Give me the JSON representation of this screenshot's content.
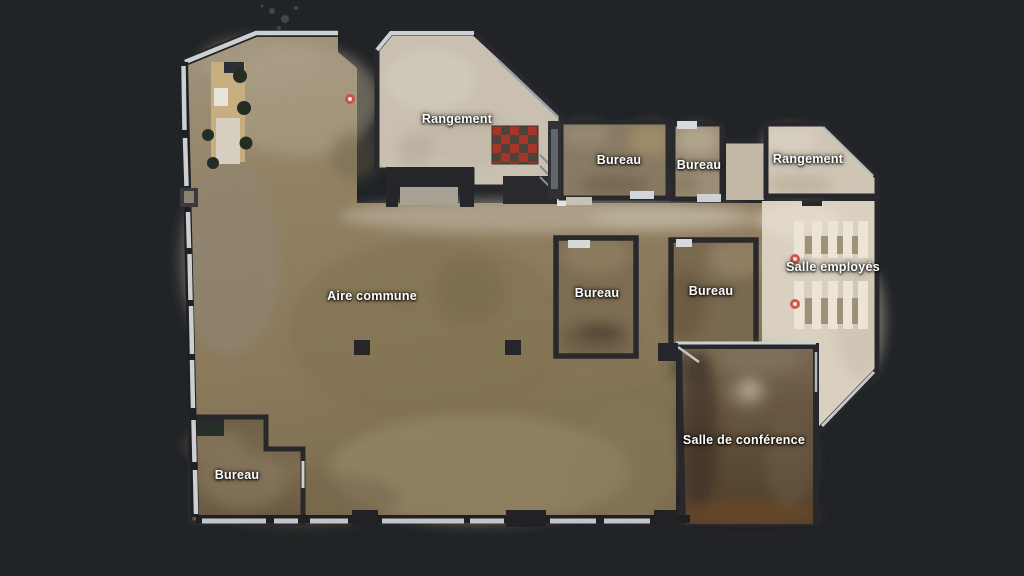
{
  "app": {
    "view": "floorplan",
    "background": "#212427"
  },
  "floorplan": {
    "rooms": [
      {
        "id": "rangement-top",
        "label": "Rangement"
      },
      {
        "id": "bureau-top-1",
        "label": "Bureau"
      },
      {
        "id": "bureau-top-2",
        "label": "Bureau"
      },
      {
        "id": "rangement-right",
        "label": "Rangement"
      },
      {
        "id": "salle-employes",
        "label": "Salle employés"
      },
      {
        "id": "aire-commune",
        "label": "Aire commune"
      },
      {
        "id": "bureau-mid-1",
        "label": "Bureau"
      },
      {
        "id": "bureau-mid-2",
        "label": "Bureau"
      },
      {
        "id": "bureau-bottom-left",
        "label": "Bureau"
      },
      {
        "id": "salle-de-conference",
        "label": "Salle de conférence"
      }
    ],
    "markers": [
      {
        "id": "scan-marker-1"
      },
      {
        "id": "scan-marker-2"
      },
      {
        "id": "scan-marker-3"
      }
    ],
    "colors": {
      "background": "#212427",
      "floor_common": "#8e7e60",
      "floor_light": "#d9d0c0",
      "floor_storage": "#c9c0b1",
      "floor_office": "#7b6b50",
      "floor_conference": "#5e4f39",
      "wall": "#27272b",
      "wall_highlight": "#ccd0d3",
      "checker_red": "#a63527",
      "checker_dark": "#4a443a",
      "scan_marker": "#d9564a",
      "label_text": "#ffffff"
    }
  }
}
